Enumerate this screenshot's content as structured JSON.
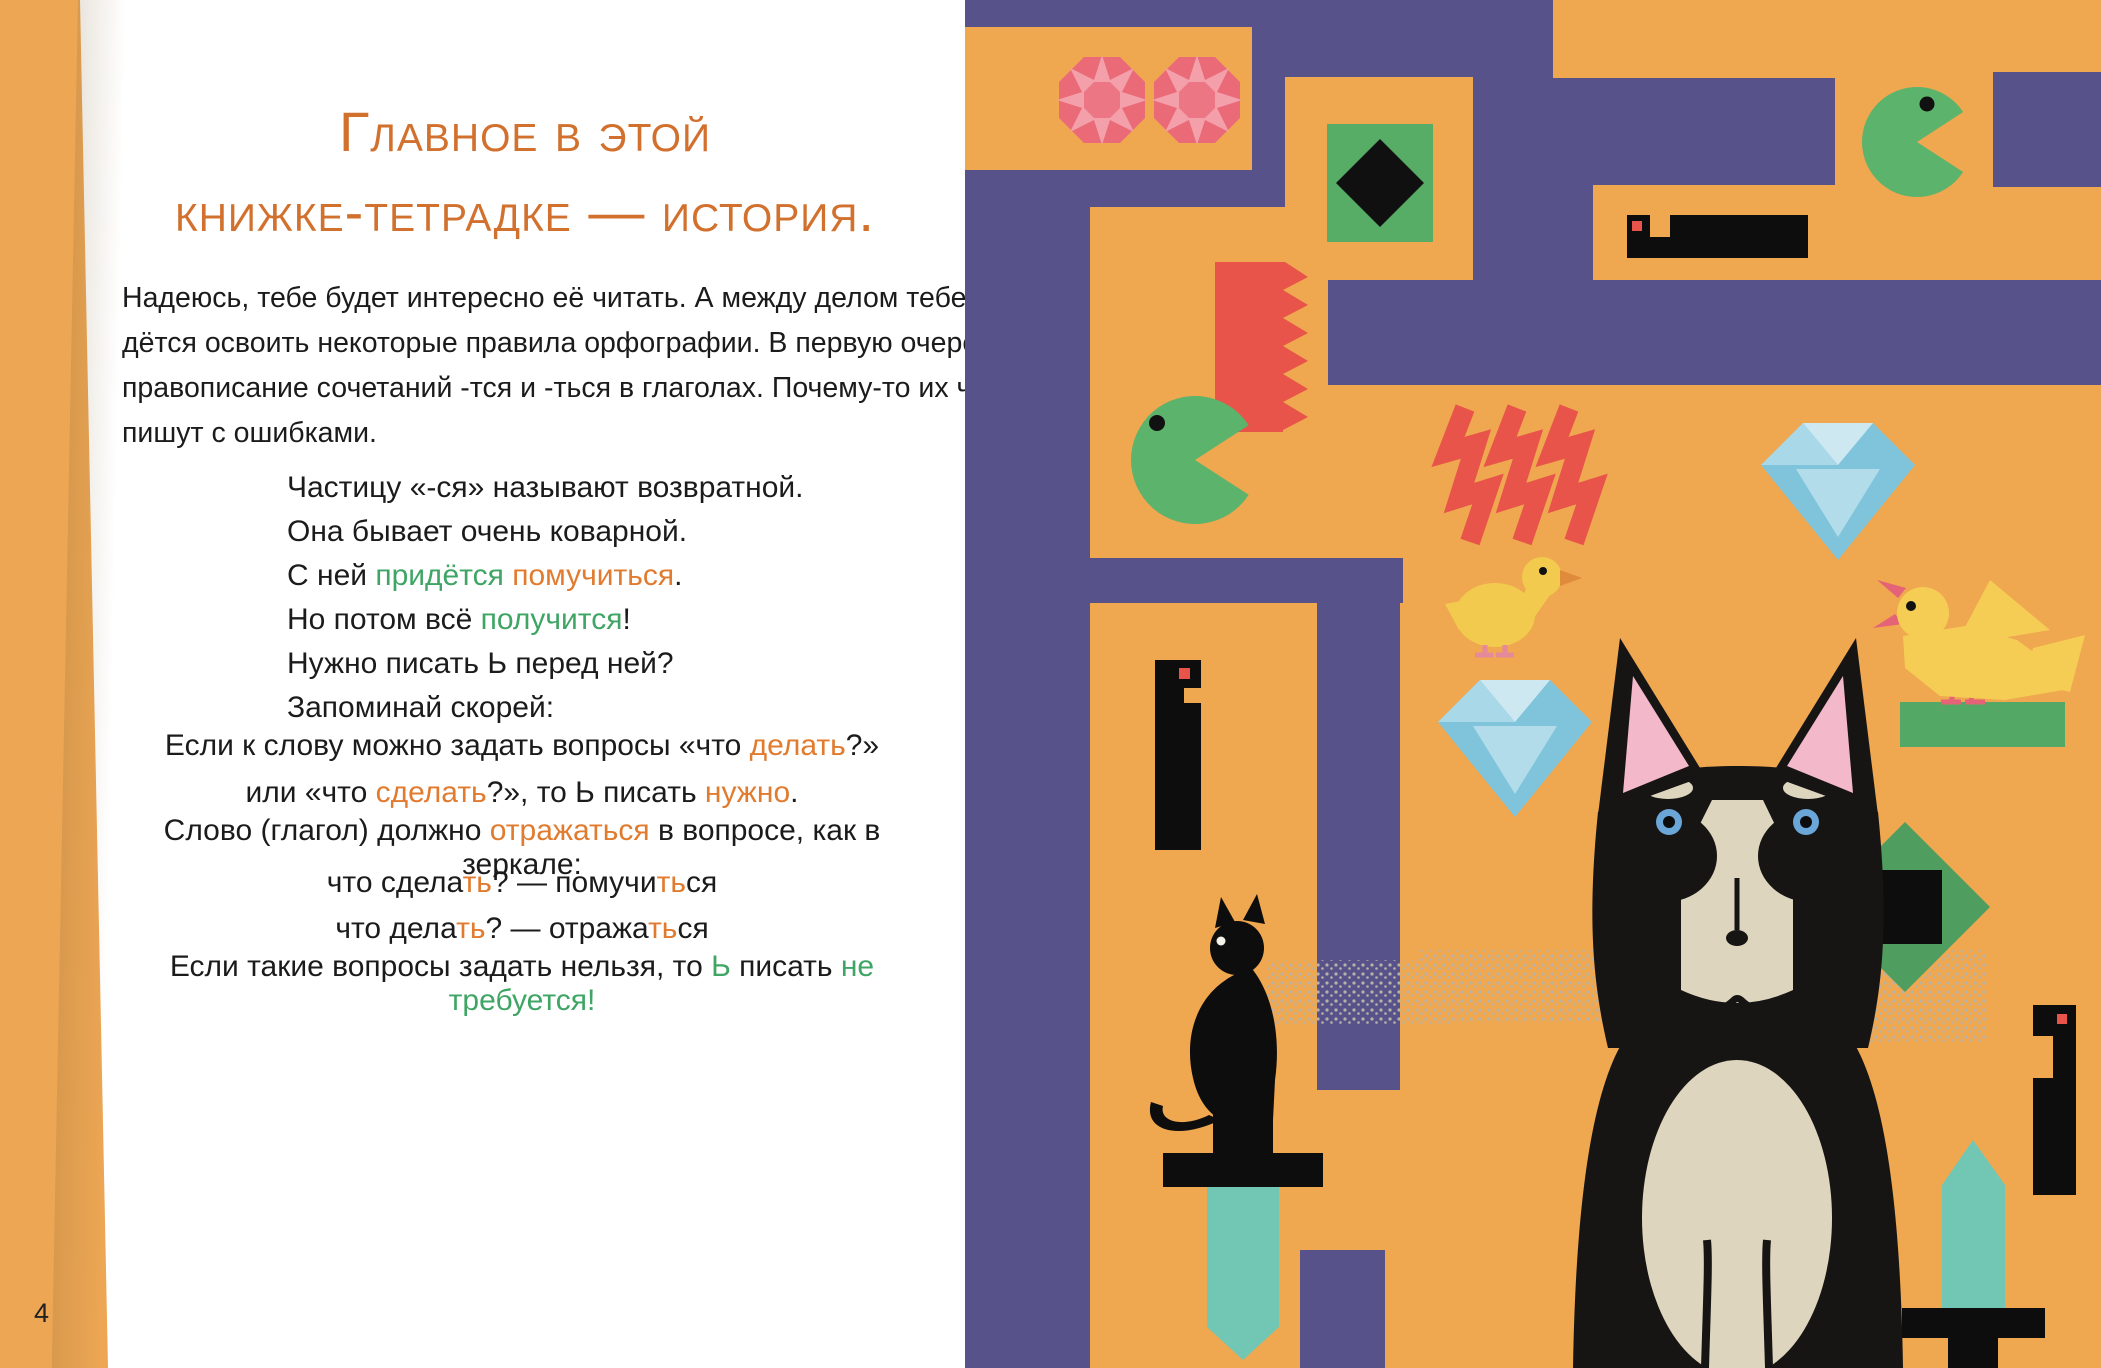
{
  "page": {
    "page_number": "4",
    "heading": {
      "line1": "Главное в этой",
      "line2": "книжке-тетрадке — история."
    },
    "paragraph": [
      "Надеюсь, тебе будет интересно её читать. А между делом тебе при-",
      "дётся освоить некоторые правила орфографии. В первую очередь —",
      "правописание сочетаний -тся и -ться в глаголах. Почему-то их часто",
      "пишут с ошибками."
    ],
    "verse": [
      [
        {
          "t": "Частицу «-ся» называют возвратной.",
          "c": "k"
        }
      ],
      [
        {
          "t": "Она бывает очень коварной.",
          "c": "k"
        }
      ],
      [
        {
          "t": "С ней ",
          "c": "k"
        },
        {
          "t": "придётся",
          "c": "g"
        },
        {
          "t": " ",
          "c": "k"
        },
        {
          "t": "помучиться",
          "c": "o"
        },
        {
          "t": ".",
          "c": "k"
        }
      ],
      [
        {
          "t": "Но потом всё ",
          "c": "k"
        },
        {
          "t": "получится",
          "c": "g"
        },
        {
          "t": "!",
          "c": "k"
        }
      ],
      [
        {
          "t": "Нужно писать Ь перед ней?",
          "c": "k"
        }
      ],
      [
        {
          "t": "Запоминай скорей:",
          "c": "k"
        }
      ]
    ],
    "rule1": [
      [
        {
          "t": "Если к слову можно задать вопросы «что ",
          "c": "k"
        },
        {
          "t": "делать",
          "c": "o"
        },
        {
          "t": "?»",
          "c": "k"
        }
      ],
      [
        {
          "t": "или «что ",
          "c": "k"
        },
        {
          "t": "сделать",
          "c": "o"
        },
        {
          "t": "?», то Ь писать ",
          "c": "k"
        },
        {
          "t": "нужно",
          "c": "o"
        },
        {
          "t": ".",
          "c": "k"
        }
      ]
    ],
    "rule2": [
      [
        {
          "t": "Слово (глагол) должно ",
          "c": "k"
        },
        {
          "t": "отражаться",
          "c": "o"
        },
        {
          "t": " в вопросе, как в зеркале:",
          "c": "k"
        }
      ]
    ],
    "mirror": [
      [
        {
          "t": "что сдела",
          "c": "k"
        },
        {
          "t": "ть",
          "c": "o"
        },
        {
          "t": "? — помучи",
          "c": "k"
        },
        {
          "t": "ть",
          "c": "o"
        },
        {
          "t": "ся",
          "c": "k"
        }
      ],
      [
        {
          "t": "что дела",
          "c": "k"
        },
        {
          "t": "ть",
          "c": "o"
        },
        {
          "t": "? — отража",
          "c": "k"
        },
        {
          "t": "ть",
          "c": "o"
        },
        {
          "t": "ся",
          "c": "k"
        }
      ]
    ],
    "rule3": [
      [
        {
          "t": "Если такие вопросы задать нельзя, то ",
          "c": "k"
        },
        {
          "t": "Ь",
          "c": "g"
        },
        {
          "t": " писать ",
          "c": "k"
        },
        {
          "t": "не требуется!",
          "c": "g"
        }
      ]
    ],
    "colors": {
      "heading_orange": "#d2712e",
      "accent_orange": "#e07b2f",
      "accent_green": "#3fa565",
      "maze_purple": "#57528a",
      "maze_orange": "#efa750",
      "spine_orange": "#eca654",
      "teal": "#72c7b4",
      "gem_pink": "#ea6a78",
      "red": "#e8544a",
      "green": "#57ad66",
      "blue": "#7fc4da",
      "yellow": "#f2cb4e"
    },
    "illustration": {
      "items": [
        "ruby-gems",
        "green-tile-black-diamond",
        "pacman-right",
        "pixel-bar",
        "red-comb",
        "pacman-left",
        "red-zigzags",
        "duck",
        "blue-diamond",
        "blue-diamond-2",
        "bird-on-perch",
        "pixel-column",
        "green-diamond-black-square",
        "black-cat-on-sword",
        "husky-dog",
        "sword-up",
        "pixel-column-2",
        "maze-walls"
      ]
    }
  }
}
